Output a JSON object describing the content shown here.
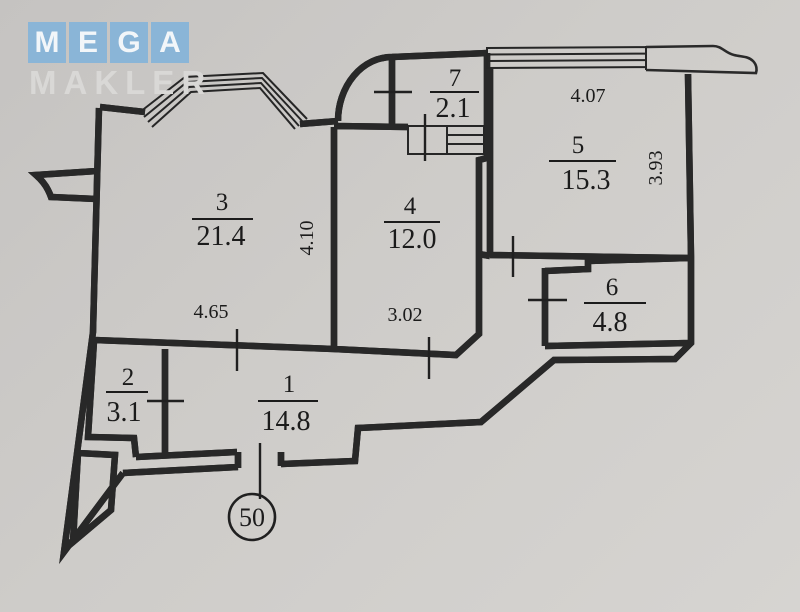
{
  "logo": {
    "tiles": [
      "M",
      "E",
      "G",
      "A"
    ],
    "subtitle": "MAKLER",
    "tile_color": "#8ab5d7",
    "letter_color": "#f2f6f9",
    "subtitle_color": "#d9d8d6"
  },
  "plan": {
    "unit_number": "50",
    "rooms": {
      "r1": {
        "number": "1",
        "area": "14.8"
      },
      "r2": {
        "number": "2",
        "area": "3.1"
      },
      "r3": {
        "number": "3",
        "area": "21.4"
      },
      "r4": {
        "number": "4",
        "area": "12.0"
      },
      "r5": {
        "number": "5",
        "area": "15.3"
      },
      "r6": {
        "number": "6",
        "area": "4.8"
      },
      "r7": {
        "number": "7",
        "area": "2.1"
      }
    },
    "dimensions": {
      "room3_width": "4.65",
      "room3_depth": "4.10",
      "room4_width": "3.02",
      "room5_width": "4.07",
      "room5_depth": "3.93"
    }
  },
  "colors": {
    "background": "#cecccа",
    "line": "#262626"
  }
}
